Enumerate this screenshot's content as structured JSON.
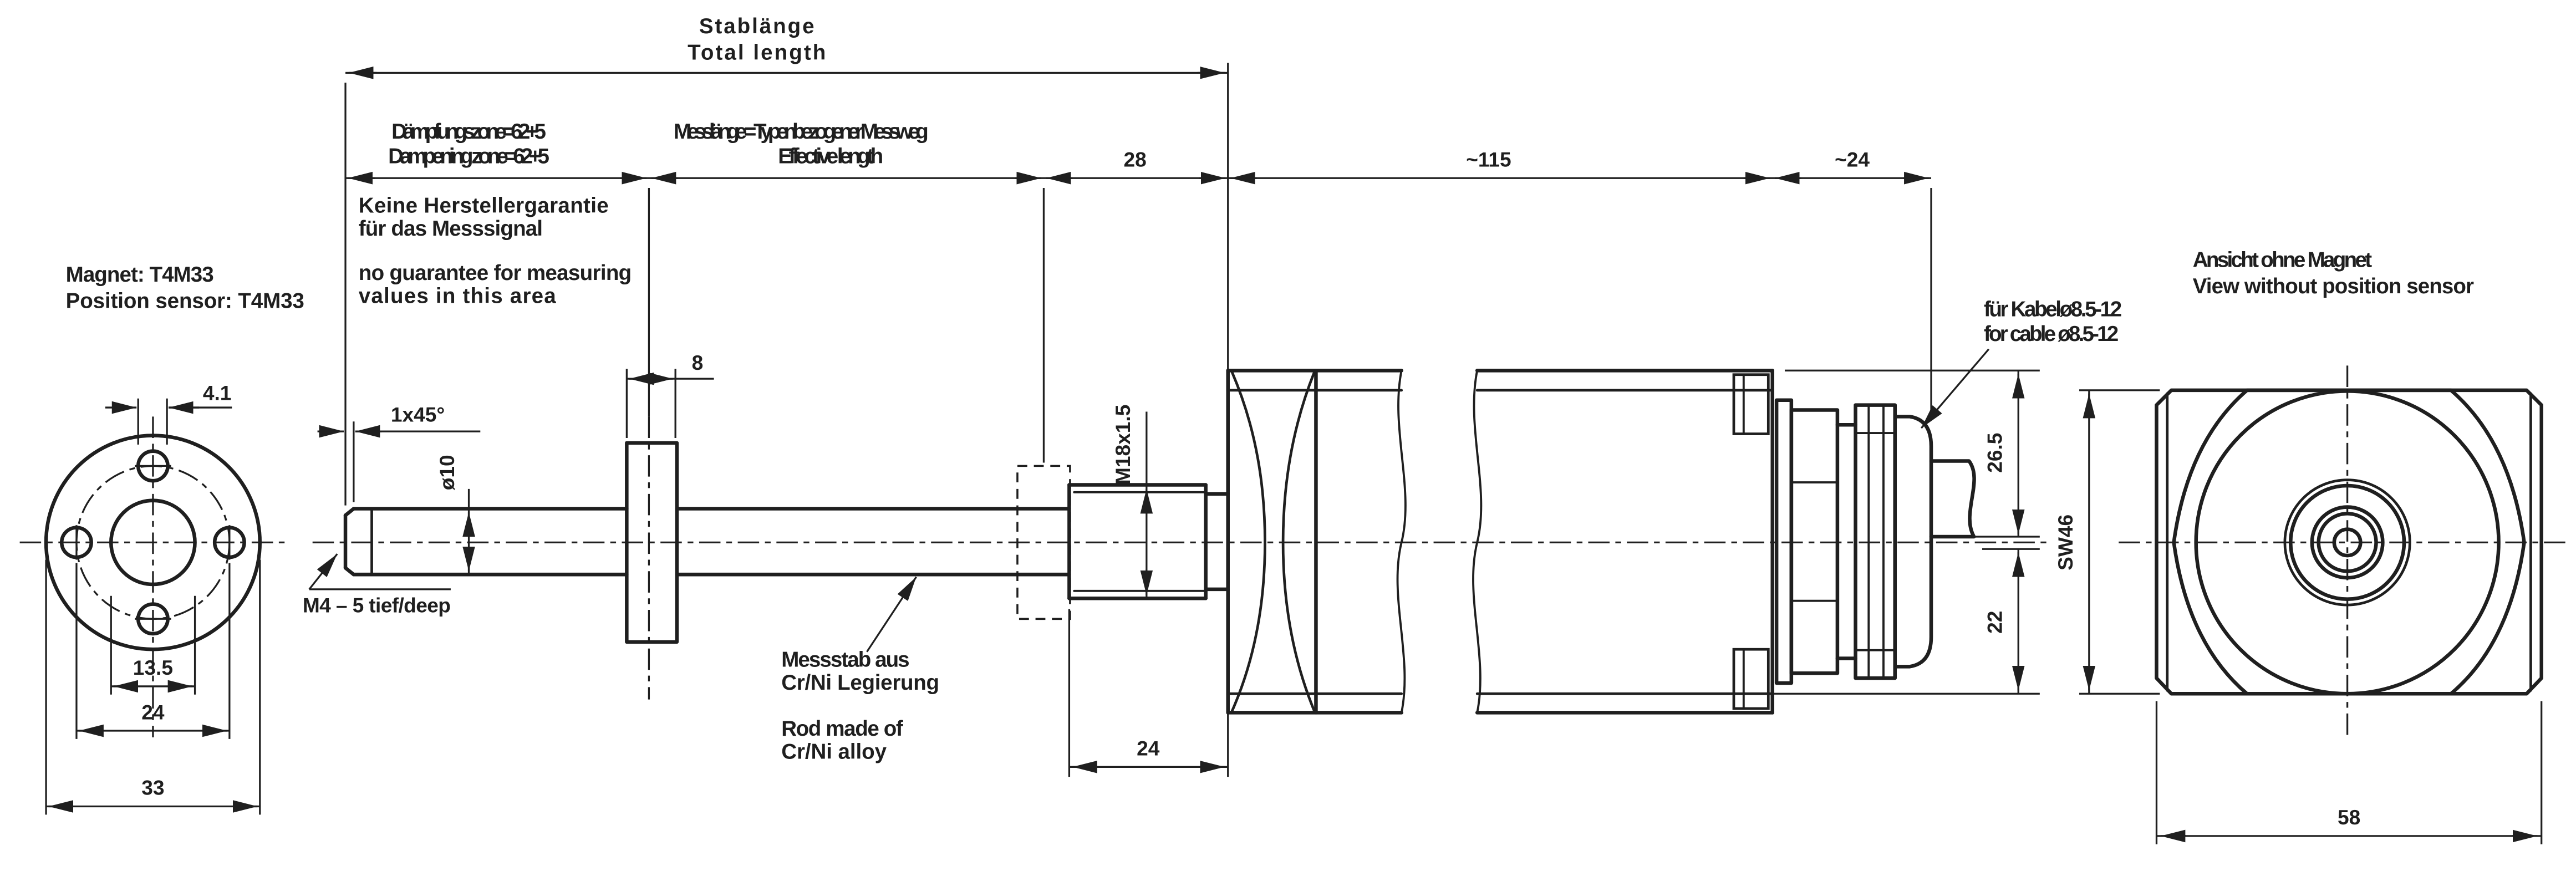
{
  "top": {
    "stab_de": "Stablänge",
    "stab_en": "Total length",
    "damp_de": "Dämpfungszone=62+5",
    "damp_en": "Dampening zone=62+5",
    "mess_de": "Messlänge = Typenbezogener Messweg",
    "mess_en": "Effective length",
    "d28": "28",
    "d115": "~115",
    "d24": "~24"
  },
  "warning": {
    "l1": "Keine Herstellergarantie",
    "l2": "für das Messsignal",
    "l3": "no guarantee for measuring",
    "l4": "values in this area"
  },
  "magnet": {
    "label_de": "Magnet: T4M33",
    "label_en": "Position sensor: T4M33",
    "d41": "4.1",
    "d135": "13.5",
    "d24": "24",
    "d33": "33"
  },
  "rod": {
    "chamfer": "1x45°",
    "dia": "ø10",
    "m4": "M4 – 5 tief/deep",
    "d8": "8",
    "mat_de1": "Messstab aus",
    "mat_de2": "Cr/Ni Legierung",
    "mat_en1": "Rod made of",
    "mat_en2": "Cr/Ni alloy",
    "thread": "M18x1.5",
    "d24": "24"
  },
  "head": {
    "cable_de": "für Kabelø8.5-12",
    "cable_en": "for cable ø8.5-12",
    "d265": "26.5",
    "d22": "22",
    "sw": "SW46"
  },
  "end_view": {
    "label_de": "Ansicht ohne Magnet",
    "label_en": "View without position sensor",
    "d58": "58"
  },
  "colors": {
    "line": "#1f1f1f",
    "bg": "#ffffff"
  }
}
